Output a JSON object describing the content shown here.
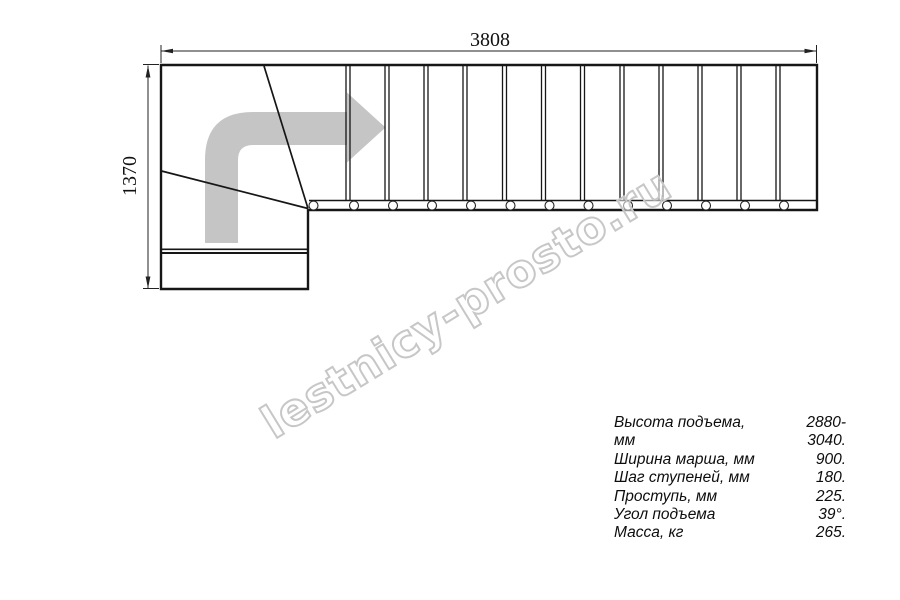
{
  "drawing": {
    "title": "stair-plan-top-view",
    "dimension_top": "3808",
    "dimension_left": "1370",
    "watermark_text": "lestnicy-prosto.ru",
    "tread_count_straight": 13,
    "baluster_count": 13
  },
  "specs": {
    "rows": [
      {
        "label": "Высота подъема, мм",
        "value": "2880-3040."
      },
      {
        "label": "Ширина марша, мм",
        "value": "900."
      },
      {
        "label": "Шаг ступеней, мм",
        "value": "180."
      },
      {
        "label": "Проступь, мм",
        "value": "225."
      },
      {
        "label": "Угол подъема",
        "value": "39°."
      },
      {
        "label": "Масса, кг",
        "value": "265."
      }
    ]
  },
  "colors": {
    "line": "#161616",
    "dim_line": "#222222",
    "arrow_fill": "#c5c5c5",
    "watermark_stroke": "#c7c7c7",
    "background": "#ffffff"
  }
}
